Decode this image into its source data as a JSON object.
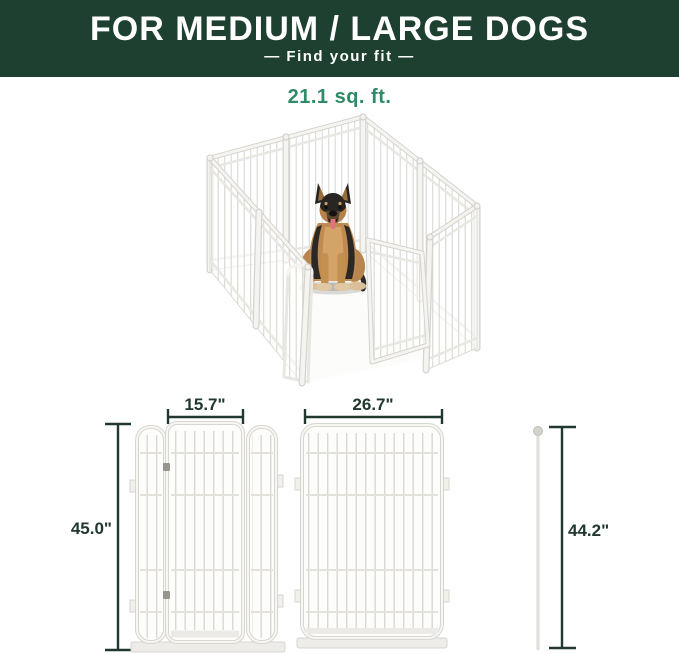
{
  "header": {
    "title": "FOR MEDIUM / LARGE DOGS",
    "subtitle": "—  Find your fit  —",
    "bg_color": "#1d4030",
    "text_color": "#ffffff"
  },
  "hero": {
    "area_label": "21.1 sq. ft.",
    "accent_color": "#2f8a67",
    "figures": {
      "pen": "white-metal-8-panel-playpen-3d-view",
      "dog": "german-shepherd-sitting-inside-pen",
      "door": "open-gate-panel"
    }
  },
  "diagrams": {
    "line_color": "#20382d",
    "panel_color": "#fdfdfc",
    "door_panel": {
      "name": "door-panel-front-view",
      "width_label": "15.7\"",
      "height_label": "45.0\""
    },
    "wide_panel": {
      "name": "regular-panel-front-view",
      "width_label": "26.7\""
    },
    "rod": {
      "name": "ground-stake",
      "height_label": "44.2\""
    }
  }
}
